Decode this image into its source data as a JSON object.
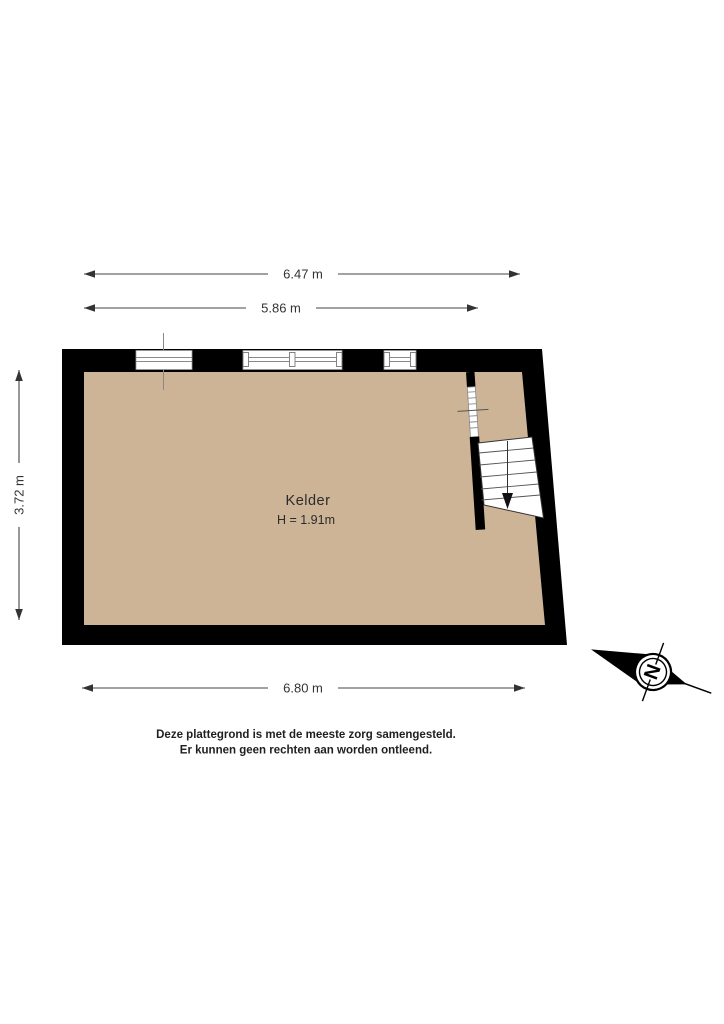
{
  "colors": {
    "floor": "#cdb496",
    "wall": "#000000",
    "window_line": "#8a8a8a",
    "dimension_line": "#444444"
  },
  "room": {
    "name": "Kelder",
    "height": "H = 1.91m"
  },
  "dimensions": {
    "top_outer": "6.47 m",
    "top_inner": "5.86 m",
    "left": "3.72 m",
    "bottom": "6.80 m"
  },
  "compass": {
    "north": "N"
  },
  "disclaimer": {
    "line1": "Deze plattegrond is met de meeste zorg samengesteld.",
    "line2": "Er kunnen geen rechten aan worden ontleend."
  }
}
